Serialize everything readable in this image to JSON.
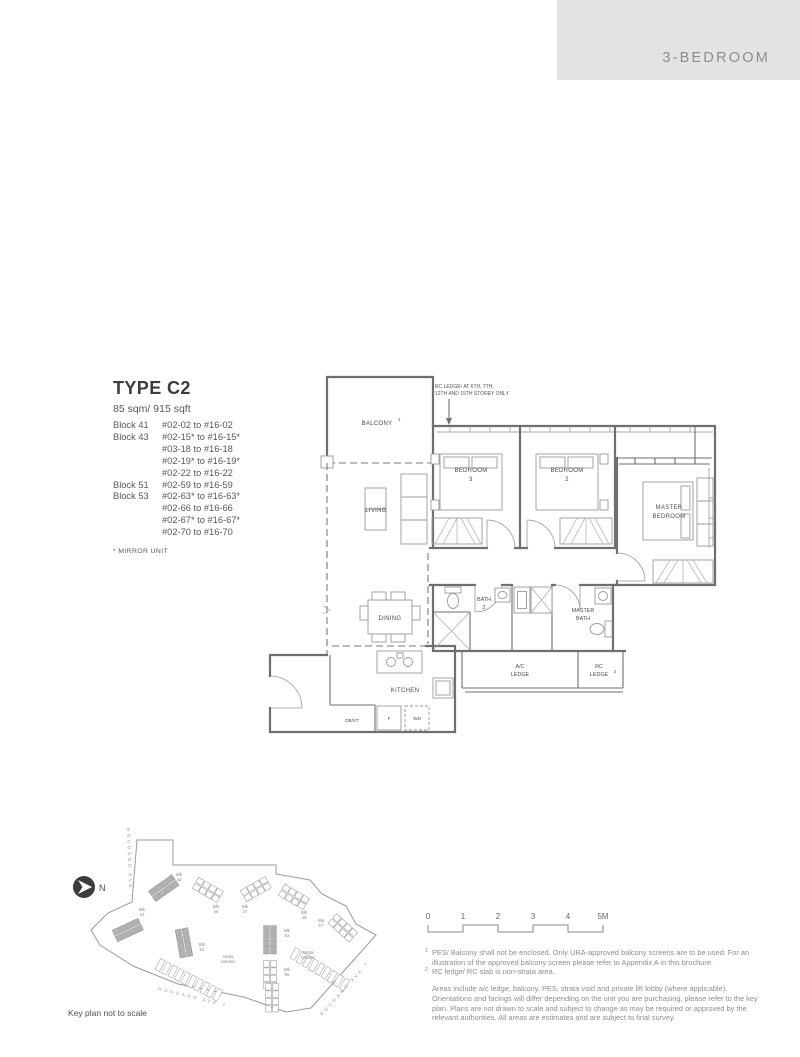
{
  "header": {
    "category": "3-BEDROOM"
  },
  "unit": {
    "type_title": "TYPE C2",
    "area": "85 sqm/ 915 sqft",
    "mirror_note": "* MIRROR UNIT",
    "blocks": [
      {
        "block": "Block 41",
        "ranges": [
          "#02-02 to #16-02"
        ]
      },
      {
        "block": "Block 43",
        "ranges": [
          "#02-15* to #16-15*",
          "#03-18 to #16-18",
          "#02-19* to #16-19*",
          "#02-22 to #16-22"
        ]
      },
      {
        "block": "Block 51",
        "ranges": [
          "#02-59 to #16-59"
        ]
      },
      {
        "block": "Block 53",
        "ranges": [
          "#02-63* to #16-63*",
          "#02-66 to #16-66",
          "#02-67* to #16-67*",
          "#02-70 to #16-70"
        ]
      }
    ]
  },
  "floorplan": {
    "labels": {
      "balcony": "BALCONY",
      "balcony_sup": "1",
      "living": "LIVING",
      "dining": "DINING",
      "kitchen": "KITCHEN",
      "dbst": "DB/ST",
      "fridge": "F",
      "wd": "WD",
      "bath2_l1": "BATH",
      "bath2_l2": "2",
      "master_bath_l1": "MASTER",
      "master_bath_l2": "BATH",
      "bedroom3_l1": "BEDROOM",
      "bedroom3_l2": "3",
      "bedroom2_l1": "BEDROOM",
      "bedroom2_l2": "2",
      "master_bedroom_l1": "MASTER",
      "master_bedroom_l2": "BEDROOM",
      "ac_ledge_l1": "A/C",
      "ac_ledge_l2": "LEDGE",
      "rc_ledge_l1": "RC",
      "rc_ledge_l2": "LEDGE",
      "rc_ledge_sup": "2"
    },
    "annotation": {
      "line1": "RC LEDGE² AT 6TH, 7TH,",
      "line2": "12TH AND 15TH STOREY ONLY"
    }
  },
  "keyplan": {
    "caption": "Key plan not to scale",
    "north_label": "N",
    "streets": [
      {
        "label": "HOUGANG AVE 7",
        "pos": "left"
      },
      {
        "label": "HOUGANG AVE 7",
        "pos": "bottom"
      },
      {
        "label": "HOUGANG AVE 7",
        "pos": "right"
      }
    ],
    "highlight_color": "#b3b2b1",
    "clusters": [
      {
        "label": "Blk 41",
        "x": 70,
        "y": 112,
        "angle": -25,
        "shaded": true,
        "lx": 84,
        "ly": 93
      },
      {
        "label": "Blk 43",
        "x": 106,
        "y": 70,
        "angle": -35,
        "shaded": true,
        "lx": 121,
        "ly": 58
      },
      {
        "label": "Blk 45",
        "x": 150,
        "y": 72,
        "angle": 30,
        "shaded": false,
        "lx": 158,
        "ly": 90
      },
      {
        "label": "Blk 47",
        "x": 198,
        "y": 71,
        "angle": -30,
        "shaded": false,
        "lx": 187,
        "ly": 90
      },
      {
        "label": "Blk 49",
        "x": 236,
        "y": 79,
        "angle": 30,
        "shaded": false,
        "lx": 246,
        "ly": 96
      },
      {
        "label": "Blk 51",
        "x": 126,
        "y": 125,
        "angle": 80,
        "shaded": true,
        "lx": 144,
        "ly": 128
      },
      {
        "label": "Blk 53",
        "x": 212,
        "y": 122,
        "angle": 90,
        "shaded": true,
        "lx": 229,
        "ly": 114
      },
      {
        "label": "Blk 55",
        "x": 212,
        "y": 157,
        "angle": 90,
        "shaded": false,
        "lx": 229,
        "ly": 153
      },
      {
        "label": "",
        "x": 214,
        "y": 180,
        "angle": 90,
        "shaded": false,
        "lx": 0,
        "ly": 0
      },
      {
        "label": "Blk 57",
        "x": 285,
        "y": 110,
        "angle": 42,
        "shaded": false,
        "lx": 263,
        "ly": 104
      }
    ],
    "strata": [
      {
        "label1": "strata",
        "label2": "landed",
        "x": 170,
        "y": 140
      },
      {
        "label1": "strata",
        "label2": "landed",
        "x": 250,
        "y": 136
      }
    ],
    "terraces": [
      {
        "x": 102,
        "y": 147,
        "n": 10,
        "dx": 6.4,
        "dy": 3.3,
        "angle": 27
      },
      {
        "x": 237,
        "y": 136,
        "n": 9,
        "dx": 6.2,
        "dy": 3.8,
        "angle": 30
      }
    ]
  },
  "scalebar": {
    "ticks": [
      "0",
      "1",
      "2",
      "3",
      "4",
      "5M"
    ]
  },
  "footnotes": [
    {
      "sup": "1",
      "text": "PES/ Balcony shall not be enclosed. Only URA-approved balcony screens are to be used. For an illustration of the approved balcony screen please refer to Appendix A in this brochure."
    },
    {
      "sup": "2",
      "text": "RC ledge/ RC slab is non-strata area."
    },
    {
      "sup": "",
      "text": "Areas include a/c ledge, balcony, PES, strata void and private lift lobby (where applicable). Orientations and facings will differ depending on the unit you are purchasing, please refer to the key plan. Plans are not drawn to scale and subject to change as may be required or approved by the relevant authorities. All areas are estimates and are subject to final survey."
    }
  ]
}
